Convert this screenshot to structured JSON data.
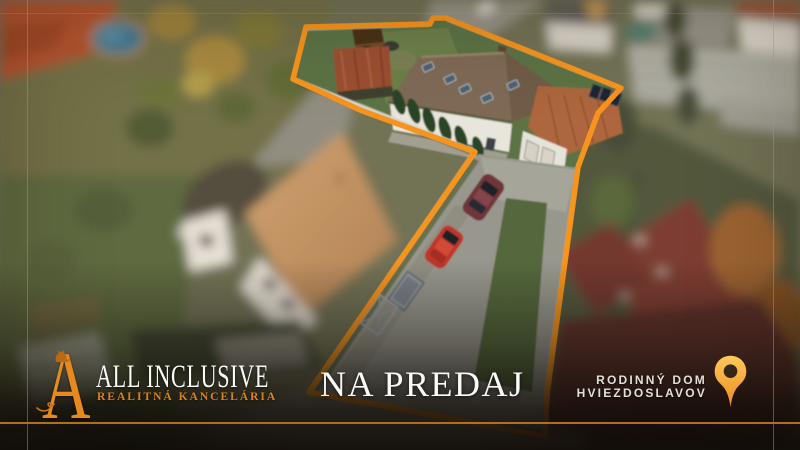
{
  "branding": {
    "monogram": "A",
    "company_name": "ALL INCLUSIVE",
    "tagline": "REALITNÁ KANCELÁRIA"
  },
  "listing": {
    "status": "NA PREDAJ",
    "property_type": "RODINNÝ DOM",
    "location": "HVIEZDOSLAVOV"
  },
  "icons": {
    "location_pin": "location-pin-icon",
    "logo_cat": "cat-silhouette-icon",
    "logo_flourish": "flourish-icon",
    "property_outline": "property-boundary-outline"
  },
  "colors": {
    "accent_orange": "#F7941D",
    "logo_orange": "#E8891E",
    "tagline_orange": "#DD831C",
    "divider_orange": "#B9741E",
    "hairline_orange": "#D98A28",
    "text_white": "#FAFAF7",
    "location_text": "#E2DFDA",
    "pin_light": "#FFC95A",
    "pin_dark": "#EC8C1E",
    "overlay_dark": "#0F0C09"
  }
}
